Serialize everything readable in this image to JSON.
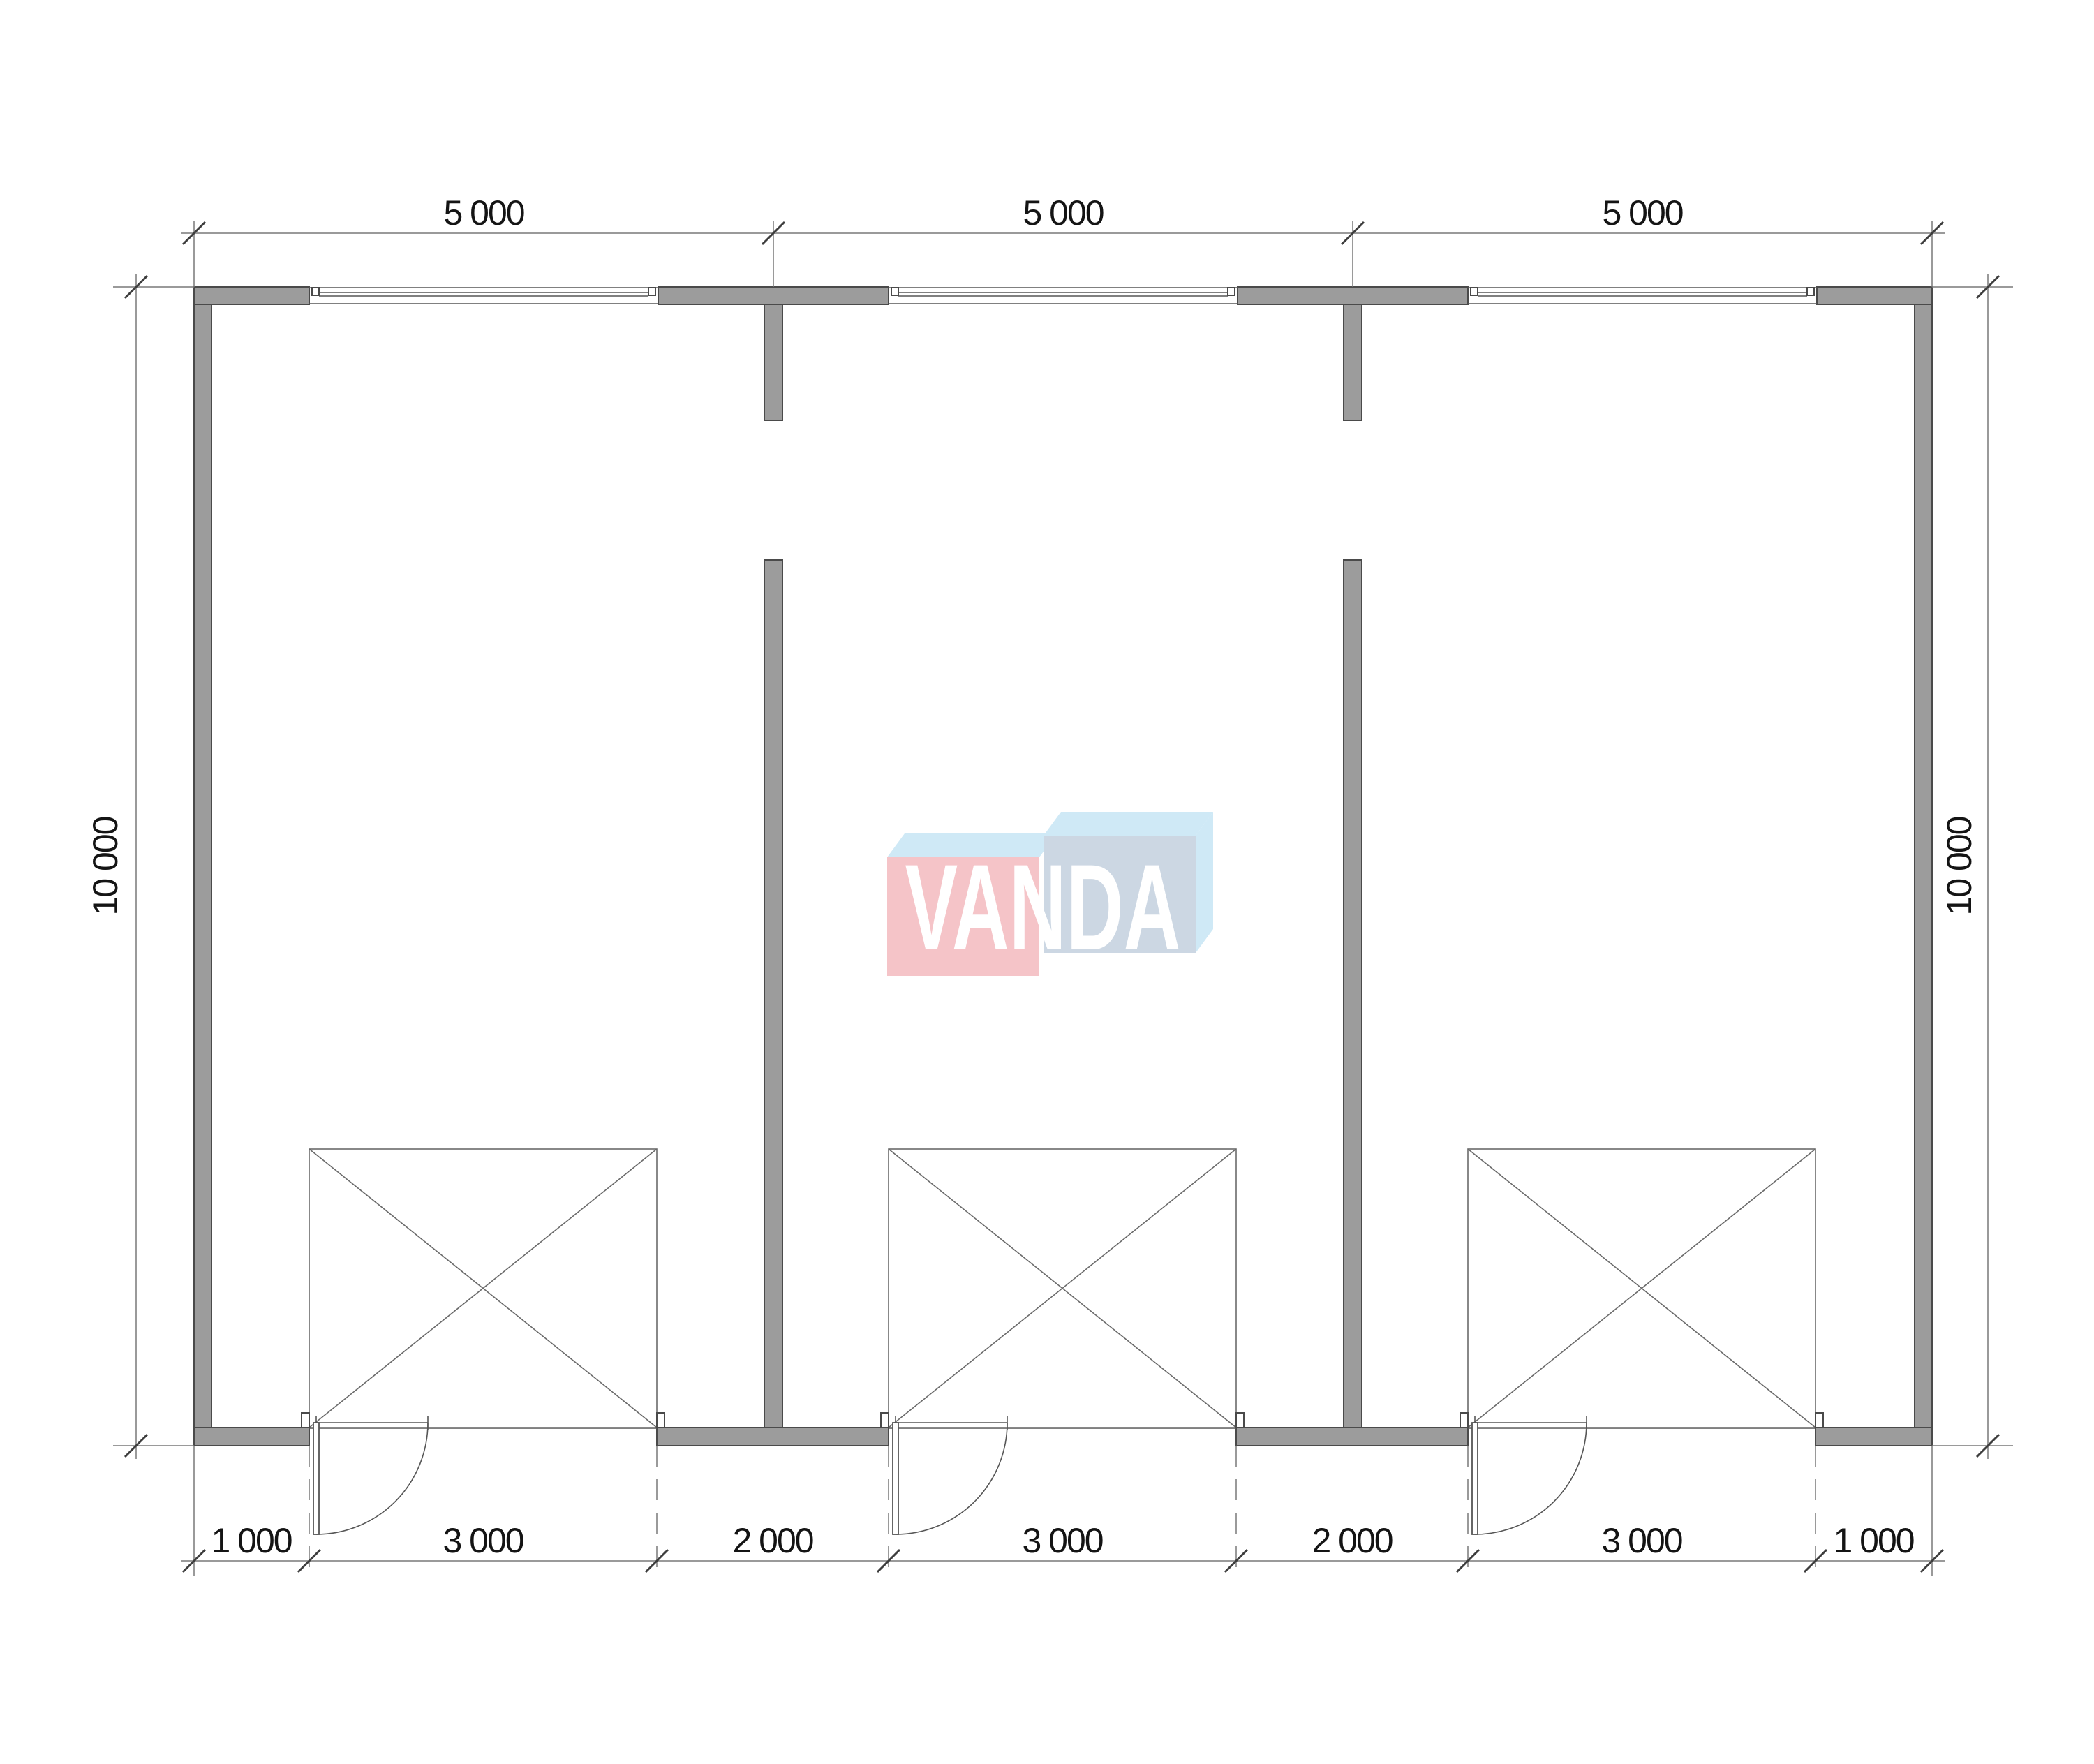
{
  "dimensions": {
    "top": [
      "5 000",
      "5 000",
      "5 000"
    ],
    "bottom": [
      "1 000",
      "3 000",
      "2 000",
      "3 000",
      "2 000",
      "3 000",
      "1 000"
    ],
    "left": "10 000",
    "right": "10 000"
  },
  "watermark": {
    "text": "VANDA",
    "pink": "#f5c4c8",
    "light_blue": "#cfe9f6",
    "blue_gray": "#ccd7e3",
    "text_color": "#ffffff"
  },
  "colors": {
    "background": "#ffffff",
    "wall_fill": "#9c9c9c",
    "wall_outline": "#4a4a4a",
    "line": "#565656",
    "dim_line": "#787878",
    "dim_text": "#141414"
  }
}
